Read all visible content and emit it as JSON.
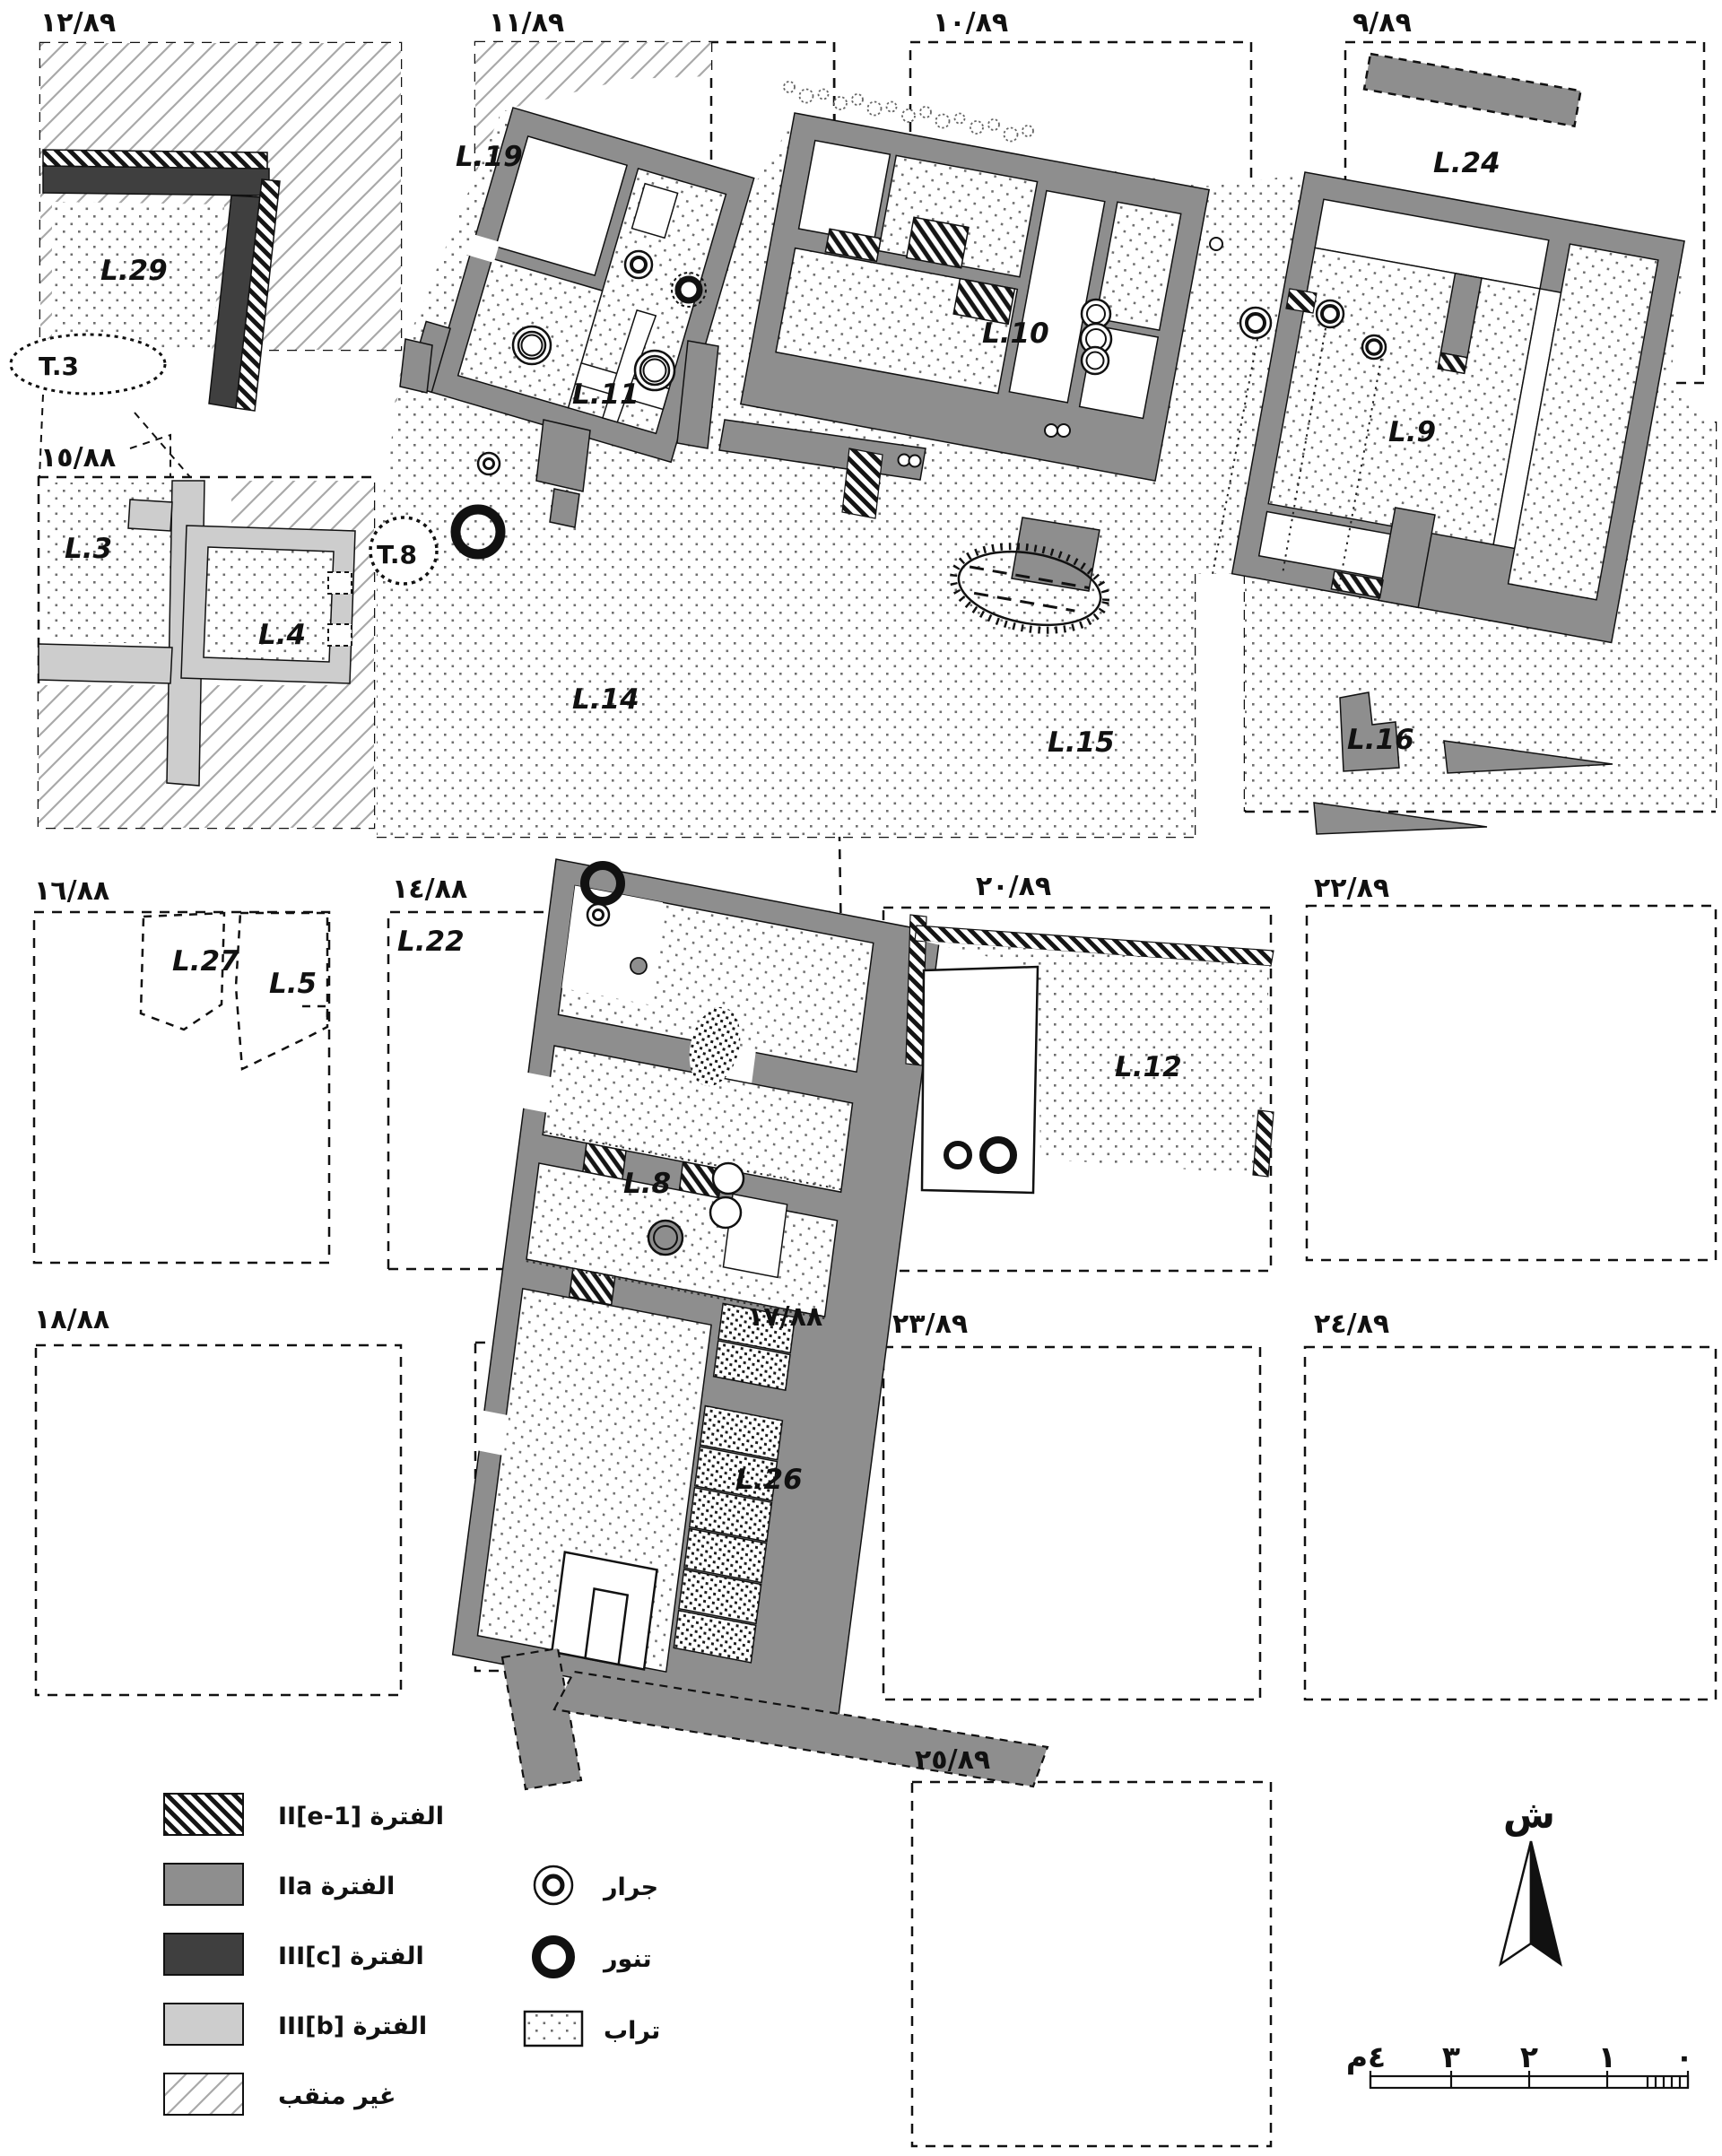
{
  "grid": {
    "s12_89": "١٢/٨٩",
    "s11_89": "١١/٨٩",
    "s10_89": "١٠/٨٩",
    "s9_89": "٩/٨٩",
    "s15_88": "١٥/٨٨",
    "s16_88": "١٦/٨٨",
    "s14_88": "١٤/٨٨",
    "s20_89": "٢٠/٨٩",
    "s22_89": "٢٢/٨٩",
    "s18_88": "١٨/٨٨",
    "s17_88": "١٧/٨٨",
    "s23_89": "٢٣/٨٩",
    "s24_89": "٢٤/٨٩",
    "s25_89": "٢٥/٨٩"
  },
  "loci": {
    "l29": "L.29",
    "l19": "L.19",
    "l11": "L.11",
    "l10": "L.10",
    "l9": "L.9",
    "l24": "L.24",
    "l3": "L.3",
    "l4": "L.4",
    "l14": "L.14",
    "l15": "L.15",
    "l16": "L.16",
    "l27": "L.27",
    "l5": "L.5",
    "l22": "L.22",
    "l8": "L.8",
    "l12": "L.12",
    "l26": "L.26"
  },
  "trenches": {
    "t3": "T.3",
    "t8": "T.8"
  },
  "legend": {
    "periods": [
      {
        "name": "period-II-e-1",
        "label": "الفترة II[e-1]",
        "swatch": "hatch-black"
      },
      {
        "name": "period-IIa",
        "label": "الفترة IIa",
        "swatch": "#8e8e8e"
      },
      {
        "name": "period-III-c",
        "label": "الفترة III[c]",
        "swatch": "#3f3f3f"
      },
      {
        "name": "period-III-b",
        "label": "الفترة III[b]",
        "swatch": "#cdcdcd"
      },
      {
        "name": "unexcavated",
        "label": "غير منقب",
        "swatch": "hatch-light"
      }
    ],
    "symbols": [
      {
        "name": "jar",
        "label": "جرار"
      },
      {
        "name": "tannur",
        "label": "تنور"
      },
      {
        "name": "soil",
        "label": "تراب"
      }
    ]
  },
  "compass": {
    "north": "ش"
  },
  "scalebar": {
    "t4": "٤م",
    "t3": "٣",
    "t2": "٢",
    "t1": "١",
    "t0": "٠"
  }
}
